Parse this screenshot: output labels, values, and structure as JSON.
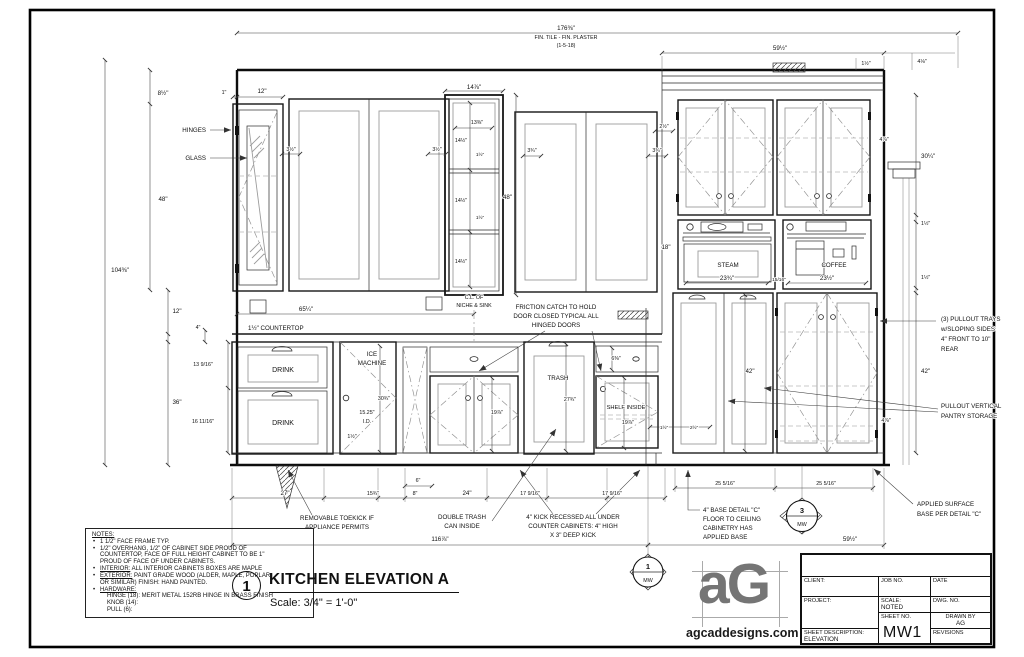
{
  "top": {
    "note1": "FIN. TILE - FIN. PLASTER",
    "note2": "(1-5-18)"
  },
  "dims": {
    "d176": "176⅜\"",
    "d59": "59½\"",
    "d112": "1½\"",
    "d418": "4⅛\"",
    "d812": "8½\"",
    "d1": "1\"",
    "d12": "12\"",
    "d312": "3½\"",
    "d1478": "14⅞\"",
    "d1338": "13⅜\"",
    "d1412": "14½\"",
    "d48": "48\"",
    "d334": "3¾\"",
    "d212": "2½\"",
    "d10438": "104⅜\"",
    "d18": "18\"",
    "d3014": "30¼\"",
    "d478": "4⅞\"",
    "d2334": "23¾\"",
    "d1516": "15/16\"",
    "d2312": "23½\"",
    "d6514": "65¼\"",
    "d4": "4\"",
    "d13916": "13 9/16\"",
    "d36": "36\"",
    "d161116": "16 11/16\"",
    "d3034": "30¾\"",
    "d1525": "15.25\"",
    "did": "I.D.",
    "d2734": "27¾\"",
    "d1978": "19⅞\"",
    "d638": "6⅜\"",
    "d42": "42\"",
    "d27": "27\"",
    "d1534": "15¾\"",
    "d8": "8\"",
    "d6": "6\"",
    "d24": "24\"",
    "d17916": "17 9/16\"",
    "d11678": "116⅞\"",
    "d25516": "25 5/16\""
  },
  "labels": {
    "hinges": "HINGES",
    "glass": "GLASS",
    "countertop": "1½\" COUNTERTOP",
    "cl1": "C.L. OF",
    "cl2": "NICHE & SINK",
    "drink": "DRINK",
    "ice1": "ICE",
    "ice2": "MACHINE",
    "trash": "TRASH",
    "shelf": "SHELF INSIDE",
    "steam": "STEAM",
    "coffee": "COFFEE"
  },
  "callouts": {
    "friction": [
      "FRICTION CATCH TO HOLD",
      "DOOR CLOSED TYPICAL ALL",
      "HINGED DOORS"
    ],
    "trays": [
      "(3) PULLOUT TRAYS",
      "w/SLOPING SIDES",
      "4\" FRONT TO 10\"",
      "REAR"
    ],
    "pantry": [
      "PULLOUT VERTICAL",
      "PANTRY STORAGE"
    ],
    "toekick": [
      "REMOVABLE TOEKICK IF",
      "APPLIANCE PERMITS"
    ],
    "dbltrash": [
      "DOUBLE TRASH",
      "CAN INSIDE"
    ],
    "kick": [
      "4\" KICK RECESSED ALL UNDER",
      "COUNTER CABINETS: 4\" HIGH",
      "X 3\" DEEP KICK"
    ],
    "based": [
      "4\" BASE DETAIL \"C\"",
      "FLOOR TO CEILING",
      "CABINETRY HAS",
      "APPLIED BASE"
    ],
    "applied": [
      "APPLIED SURFACE",
      "BASE PER DETAIL \"C\""
    ]
  },
  "markers": {
    "m1": "1",
    "m3": "3",
    "sheet": "MW"
  },
  "title": {
    "num": "1",
    "text": "KITCHEN ELEVATION A",
    "scale": "Scale: 3/4\" = 1'-0\""
  },
  "notes": {
    "heading": "NOTES:",
    "b1": "1 1/2\" FACE FRAME TYP.",
    "b2a": "1/2\" OVERHANG, 1/2\" OF CABINET SIDE PROUD OF",
    "b2b": "COUNTERTOP, FACE OF FULL HEIGHT CABINET TO BE 1\"",
    "b2c": "PROUD OF FACE OF UNDER CABINETS.",
    "b3_lead": "INTERIOR:",
    "b3_rest": " ALL INTERIOR CABINETS BOXES ARE MAPLE",
    "b4_lead": "EXTERIOR:",
    "b4_rest": " PAINT GRADE WOOD (ALDER, MAPLE, POPLAR",
    "b4b": "OR SIMILAR) FINISH: HAND PAINTED.",
    "b5_lead": "HARDWARE:",
    "b5a": "HINGE (18): MERIT METAL 152RB HINGE IN BRASS FINISH",
    "b5b": "KNOB (14):",
    "b5c": "PULL (6):"
  },
  "titleblock": {
    "client": "CLIENT:",
    "job": "JOB NO.",
    "date": "DATE",
    "project": "PROJECT:",
    "scale_label": "SCALE:",
    "scale_value": "NOTED",
    "dwg": "DWG. NO.",
    "drawn_label": "DRAWN BY",
    "drawn_value": "AG",
    "sheetno_label": "SHEET NO.",
    "sheet_number": "MW1",
    "desc_label": "SHEET DESCRIPTION:",
    "desc_value": "ELEVATION",
    "revisions": "REVISIONS"
  },
  "logo": {
    "mark": "aG",
    "site": "agcaddesigns.com"
  }
}
